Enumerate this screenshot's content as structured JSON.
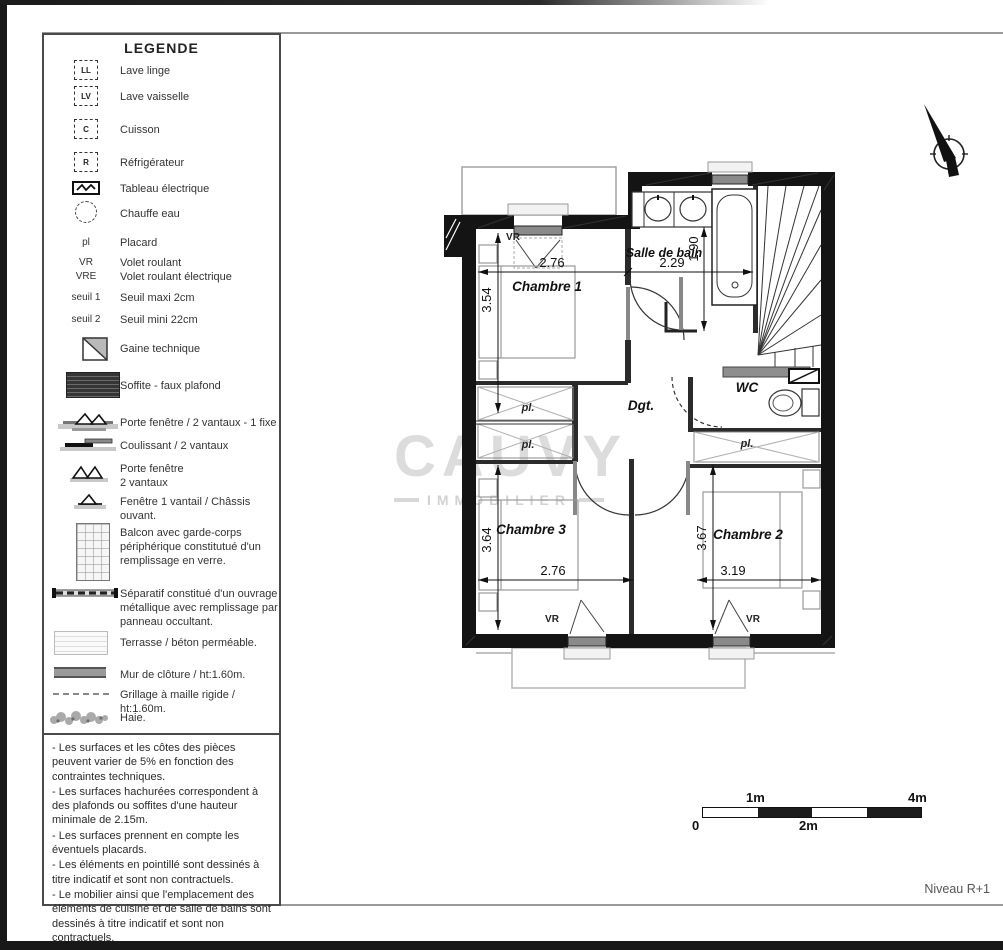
{
  "legend": {
    "title": "LEGENDE",
    "items": [
      {
        "icon": "washing-machine-symbol",
        "symbol": "LL",
        "label": "Lave linge"
      },
      {
        "icon": "dishwasher-symbol",
        "symbol": "LV",
        "label": "Lave vaisselle"
      },
      {
        "icon": "cooktop-symbol",
        "symbol": "C",
        "label": "Cuisson"
      },
      {
        "icon": "refrigerator-symbol",
        "symbol": "R",
        "label": "Réfrigérateur"
      },
      {
        "icon": "electrical-panel-symbol",
        "label": "Tableau électrique"
      },
      {
        "icon": "water-heater-symbol",
        "label": "Chauffe eau"
      },
      {
        "symbol": "pl",
        "label": "Placard"
      },
      {
        "symbol": "VR",
        "label": "Volet roulant"
      },
      {
        "symbol": "VRE",
        "label": "Volet roulant électrique"
      },
      {
        "symbol": "seuil 1",
        "label": "Seuil maxi 2cm"
      },
      {
        "symbol": "seuil 2",
        "label": "Seuil mini 22cm"
      },
      {
        "icon": "technical-duct-symbol",
        "label": "Gaine technique"
      },
      {
        "icon": "soffit-hatch-symbol",
        "label": "Soffite - faux plafond"
      },
      {
        "icon": "french-door-2-leaf-1-fixed-symbol",
        "label": "Porte fenêtre / 2 vantaux - 1 fixe"
      },
      {
        "icon": "sliding-door-symbol",
        "label": "Coulissant / 2 vantaux"
      },
      {
        "icon": "french-door-2-leaf-symbol",
        "label": "Porte fenêtre",
        "label2": "2 vantaux"
      },
      {
        "icon": "window-1-leaf-symbol",
        "label": "Fenêtre 1 vantail / Châssis ouvant."
      },
      {
        "icon": "balcony-grid-symbol",
        "label": "Balcon avec garde-corps périphérique constitutué d'un remplissage en verre."
      },
      {
        "icon": "metal-separator-symbol",
        "label": "Séparatif constitué d'un ouvrage métallique avec remplissage par panneau occultant."
      },
      {
        "icon": "terrace-symbol",
        "label": "Terrasse / béton perméable."
      },
      {
        "icon": "closure-wall-symbol",
        "label": "Mur de clôture / ht:1.60m."
      },
      {
        "icon": "rigid-mesh-fence-symbol",
        "label": "Grillage à maille rigide / ht:1.60m."
      },
      {
        "icon": "hedge-symbol",
        "label": "Haie."
      }
    ]
  },
  "notes": {
    "lines": [
      "- Les surfaces et les côtes des pièces peuvent varier de 5% en fonction des contraintes techniques.",
      "- Les surfaces hachurées correspondent à des plafonds ou soffites d'une hauteur minimale de 2.15m.",
      "- Les surfaces prennent en compte les éventuels placards.",
      "- Les éléments en pointillé sont dessinés à titre indicatif et sont non contractuels.",
      "- Le mobilier ainsi que l'emplacement des éléments de cuisine et de salle de bains sont dessinés à titre indicatif et sont non contractuels."
    ]
  },
  "plan": {
    "rooms": {
      "chambre1": "Chambre 1",
      "salle_de_bain": "Salle de bain",
      "wc": "WC",
      "degagement": "Dgt.",
      "chambre3": "Chambre 3",
      "chambre2": "Chambre 2"
    },
    "labels": {
      "placard": "pl.",
      "volet_roulant": "VR"
    },
    "dimensions": {
      "chambre1_width": "2.76",
      "chambre1_height": "3.54",
      "salle_de_bain_width": "2.29",
      "salle_de_bain_height": "1.90",
      "chambre3_width": "2.76",
      "chambre3_height": "3.64",
      "chambre2_width": "3.19",
      "chambre2_height": "3.67"
    }
  },
  "scale_bar": {
    "zero": "0",
    "one": "1m",
    "two": "2m",
    "four": "4m"
  },
  "watermark": {
    "line1": "CAUVY",
    "line2": "IMMOBILIER"
  },
  "footer": {
    "level_label": "Niveau R+1"
  }
}
